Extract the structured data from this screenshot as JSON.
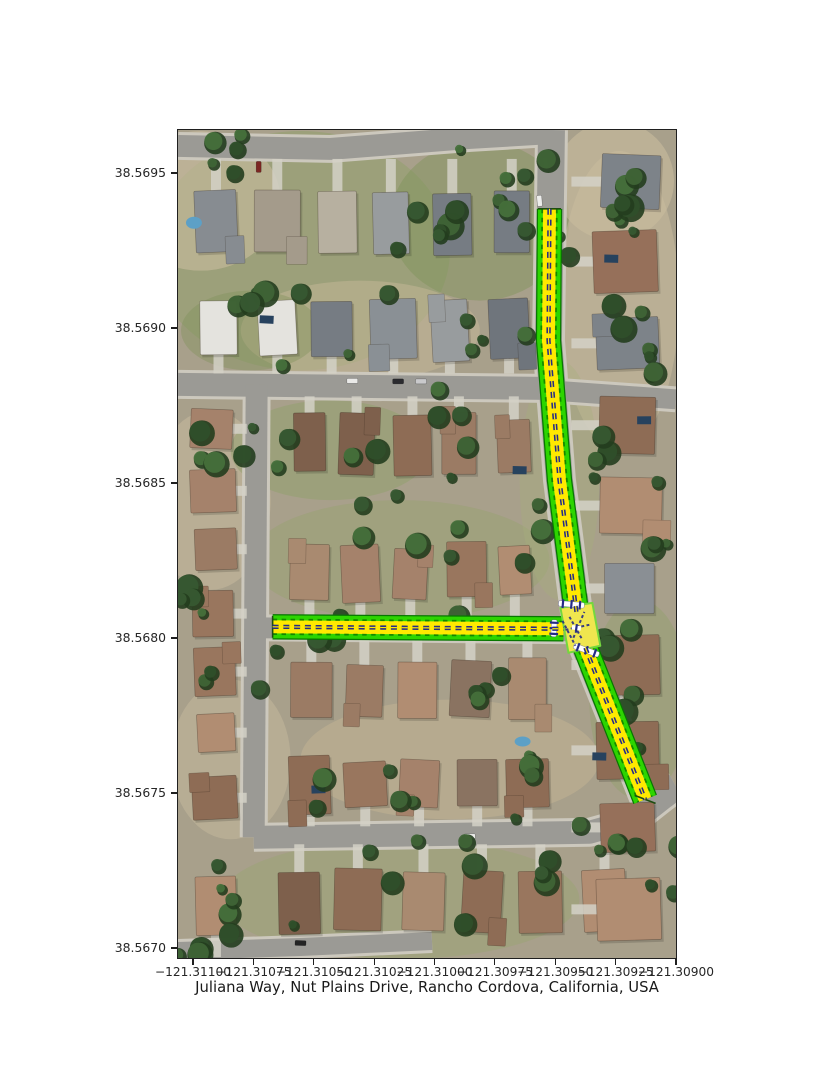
{
  "figure": {
    "title": "Juliana Way, Nut Plains Drive, Rancho Cordova, California, USA",
    "plot_area": {
      "left": 177,
      "top": 129,
      "width": 500,
      "height": 830
    },
    "y_axis": {
      "ticks": [
        {
          "label": "38.5695",
          "y": 173
        },
        {
          "label": "38.5690",
          "y": 328
        },
        {
          "label": "38.5685",
          "y": 483
        },
        {
          "label": "38.5680",
          "y": 638
        },
        {
          "label": "38.5675",
          "y": 793
        },
        {
          "label": "38.5670",
          "y": 948
        }
      ]
    },
    "x_axis": {
      "ticks": [
        {
          "label": "−121.31100",
          "x": 193
        },
        {
          "label": "−121.31075",
          "x": 253.4
        },
        {
          "label": "−121.31050",
          "x": 313.8
        },
        {
          "label": "−121.31025",
          "x": 374.1
        },
        {
          "label": "−121.31000",
          "x": 434.5
        },
        {
          "label": "−121.30975",
          "x": 494.9
        },
        {
          "label": "−121.30950",
          "x": 555.3
        },
        {
          "label": "−121.30925",
          "x": 615.6
        },
        {
          "label": "−121.30900",
          "x": 676
        }
      ]
    }
  },
  "map": {
    "colors": {
      "route_edge_green": "#077700",
      "route_green": "#2dd500",
      "route_yellow": "#ffe900",
      "route_navy": "#252c87",
      "stop_bar_white": "#ffffff",
      "junction_yellow": "#efe64f",
      "street_gray": "#9b9a95",
      "curb_light": "#ccc8bd",
      "ground_tan": "#a8a08b"
    },
    "route": {
      "segments": [
        {
          "id": "nut-plains-drive-north",
          "points": [
            [
              550,
              208
            ],
            [
              549,
              340
            ],
            [
              560,
              480
            ],
            [
              577,
              612
            ]
          ]
        },
        {
          "id": "juliana-way",
          "points": [
            [
              272,
              627
            ],
            [
              564,
              629
            ]
          ]
        },
        {
          "id": "nut-plains-drive-south",
          "points": [
            [
              586,
              648
            ],
            [
              646,
              800
            ]
          ]
        }
      ],
      "stop_bars": [
        {
          "x": 572,
          "y": 604.5,
          "len": 26,
          "rot": 5
        },
        {
          "x": 554.5,
          "y": 628.5,
          "len": 17,
          "rot": 93
        },
        {
          "x": 587,
          "y": 650.5,
          "len": 27,
          "rot": 20
        }
      ],
      "junction": {
        "outline": [
          [
            561,
            608
          ],
          [
            593,
            603
          ],
          [
            601,
            646
          ],
          [
            569,
            653
          ]
        ],
        "cx": 577,
        "cy": 628
      }
    },
    "streets": [
      {
        "id": "street-top",
        "points": [
          [
            177,
            145
          ],
          [
            330,
            148
          ],
          [
            470,
            137
          ],
          [
            552,
            132
          ]
        ],
        "w": 22
      },
      {
        "id": "nut-plains-drive-street",
        "points": [
          [
            552,
            129
          ],
          [
            549,
            340
          ],
          [
            560,
            480
          ],
          [
            577,
            612
          ],
          [
            586,
            648
          ],
          [
            647,
            800
          ],
          [
            668,
            792
          ],
          [
            677,
            787
          ]
        ],
        "w": 27
      },
      {
        "id": "street-middle",
        "points": [
          [
            177,
            384
          ],
          [
            545,
            388
          ]
        ],
        "w": 23
      },
      {
        "id": "street-middle-east",
        "points": [
          [
            565,
            391
          ],
          [
            677,
            399
          ]
        ],
        "w": 20
      },
      {
        "id": "street-west-vertical",
        "points": [
          [
            256,
            384
          ],
          [
            253,
            838
          ]
        ],
        "w": 22
      },
      {
        "id": "street-bottom",
        "points": [
          [
            253,
            838
          ],
          [
            590,
            833
          ],
          [
            637,
            820
          ],
          [
            665,
            798
          ],
          [
            677,
            789
          ]
        ],
        "w": 23
      },
      {
        "id": "juliana-way-street",
        "points": [
          [
            258,
            628
          ],
          [
            575,
            631
          ]
        ],
        "w": 21
      },
      {
        "id": "street-bottom-left",
        "points": [
          [
            177,
            952
          ],
          [
            300,
            948
          ],
          [
            432,
            942
          ]
        ],
        "w": 18
      }
    ]
  }
}
